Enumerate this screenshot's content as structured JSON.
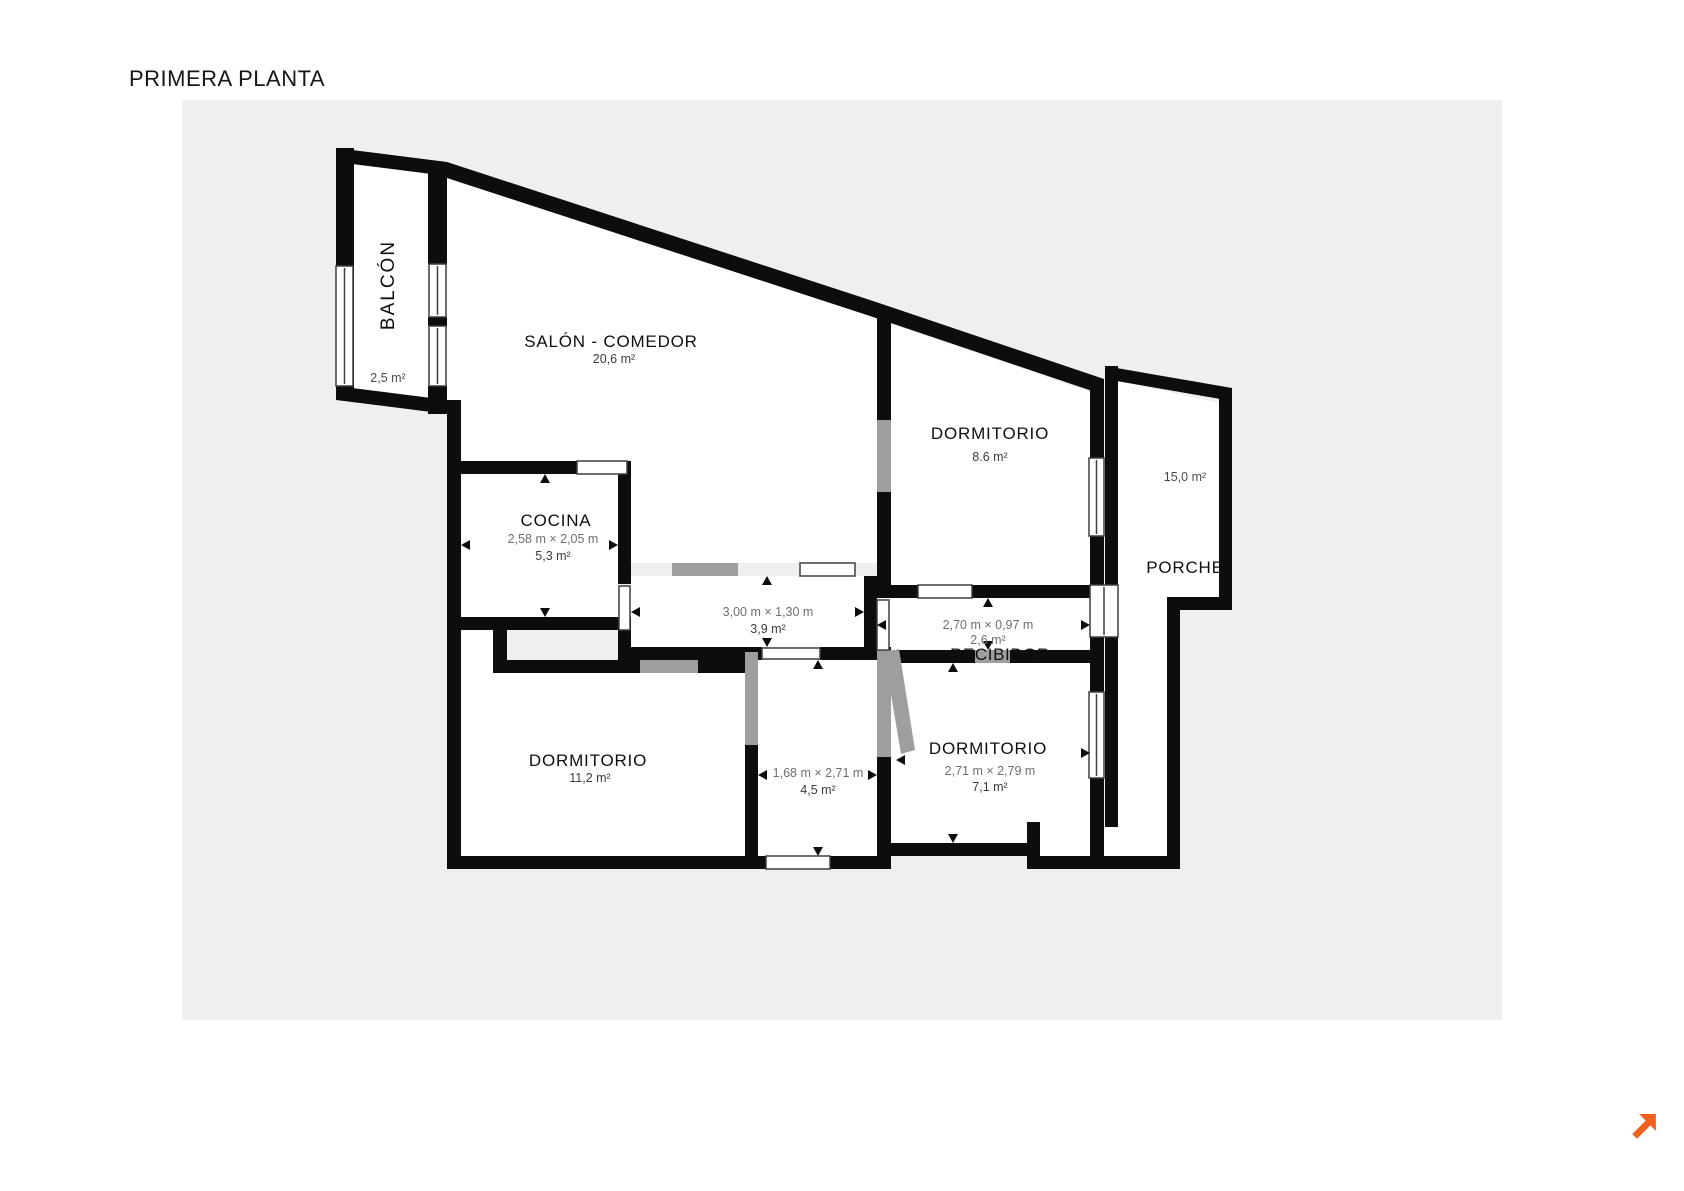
{
  "page": {
    "title": "PRIMERA PLANTA"
  },
  "plan": {
    "rooms": {
      "balcon": {
        "name": "BALCÓN",
        "area": "2,5 m²"
      },
      "salon_comedor": {
        "name": "SALÓN - COMEDOR",
        "area": "20,6 m²"
      },
      "dormitorio_superior": {
        "name": "DORMITORIO",
        "area": "8.6 m²"
      },
      "porche": {
        "name": "PORCHE",
        "area": "15,0 m²"
      },
      "cocina": {
        "name": "COCINA",
        "dims": "2,58 m × 2,05 m",
        "area": "5,3 m²"
      },
      "pasillo": {
        "dims": "3,00 m × 1,30 m",
        "area": "3,9 m²"
      },
      "recibidor": {
        "name": "RECIBIDOR",
        "dims": "2,70 m × 0,97 m",
        "area": "2,6 m²"
      },
      "dormitorio_izquierdo": {
        "name": "DORMITORIO",
        "area": "11,2 m²"
      },
      "habitacion_central": {
        "dims": "1,68 m × 2,71 m",
        "area": "4,5 m²"
      },
      "dormitorio_derecho": {
        "name": "DORMITORIO",
        "dims": "2,71 m × 2,79 m",
        "area": "7,1 m²"
      }
    },
    "colors": {
      "wall": "#0d0d0d",
      "panel_background": "#f0efed",
      "door_opening_gray": "#9e9e9e",
      "logo_orange": "#f4611e"
    }
  }
}
